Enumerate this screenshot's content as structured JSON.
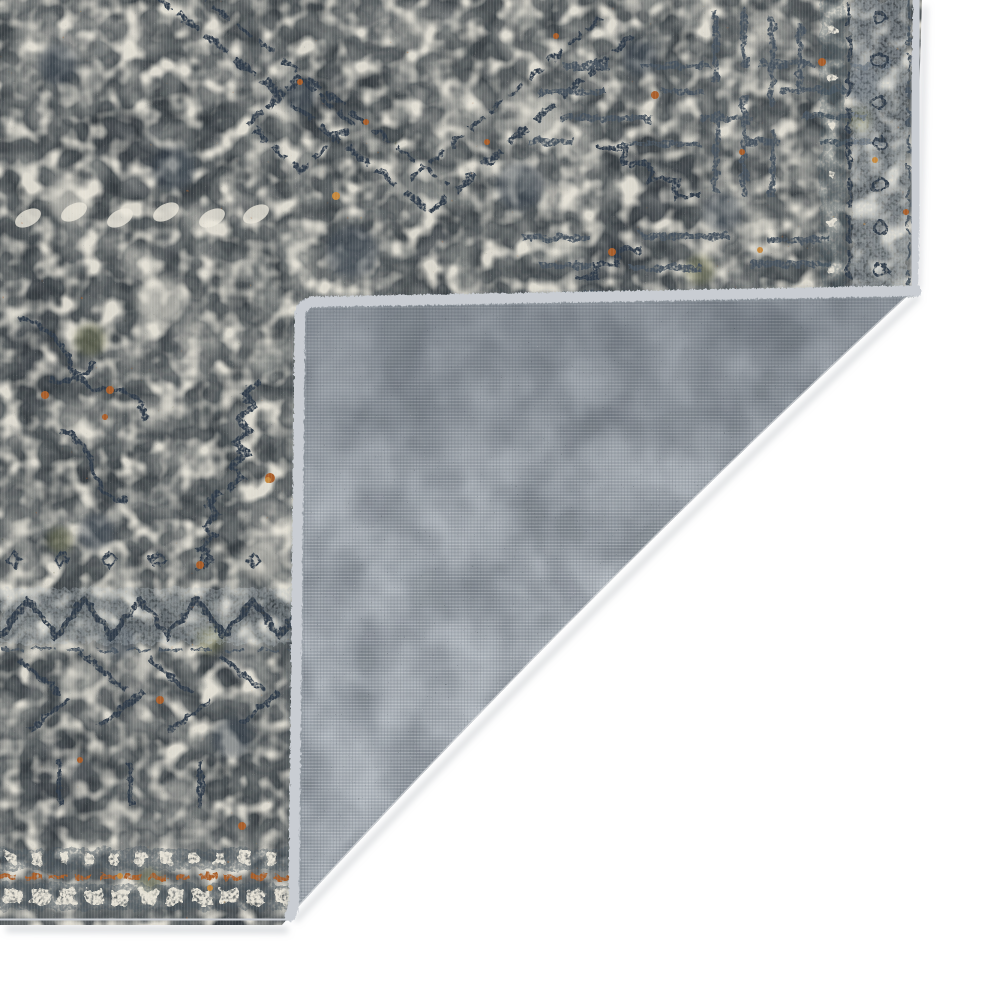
{
  "scene": {
    "type": "product-photo",
    "description": "Corner of a distressed grey-blue traditional area rug with its bottom-right corner folded back to reveal the woven grey backing, photographed on a white background",
    "subject": "vintage-style distressed oriental area rug, corner folded showing reverse side",
    "fold": "bottom-right corner folded over",
    "background": "white studio backdrop"
  },
  "colors": {
    "background": "#ffffff",
    "face_base": "#d9d5ca",
    "face_ivory": "#ece8dc",
    "face_slate": "#5b6a76",
    "face_gray": "#7d8791",
    "face_navy": "#2e3b49",
    "face_slate_dark": "#46525e",
    "face_bluegray": "#b7bfc6",
    "face_olive": "#6f7247",
    "face_rust": "#a85c28",
    "face_amber": "#c6883c",
    "face_grain_dark": "#474f57",
    "face_grain_light": "#f2efe6",
    "backing_base": "#aeb5bc",
    "backing_light": "#dfe2e5",
    "backing_dark": "#3e4750",
    "backing_mottle": "#818991",
    "backing_ghost": "#6a727b",
    "binding": "#c9cdd3",
    "binding_seam": "#8f979e",
    "shadow": "#aab0b5",
    "band_ground_dark": "#46515c",
    "band_cream": "#e6e2d6"
  }
}
